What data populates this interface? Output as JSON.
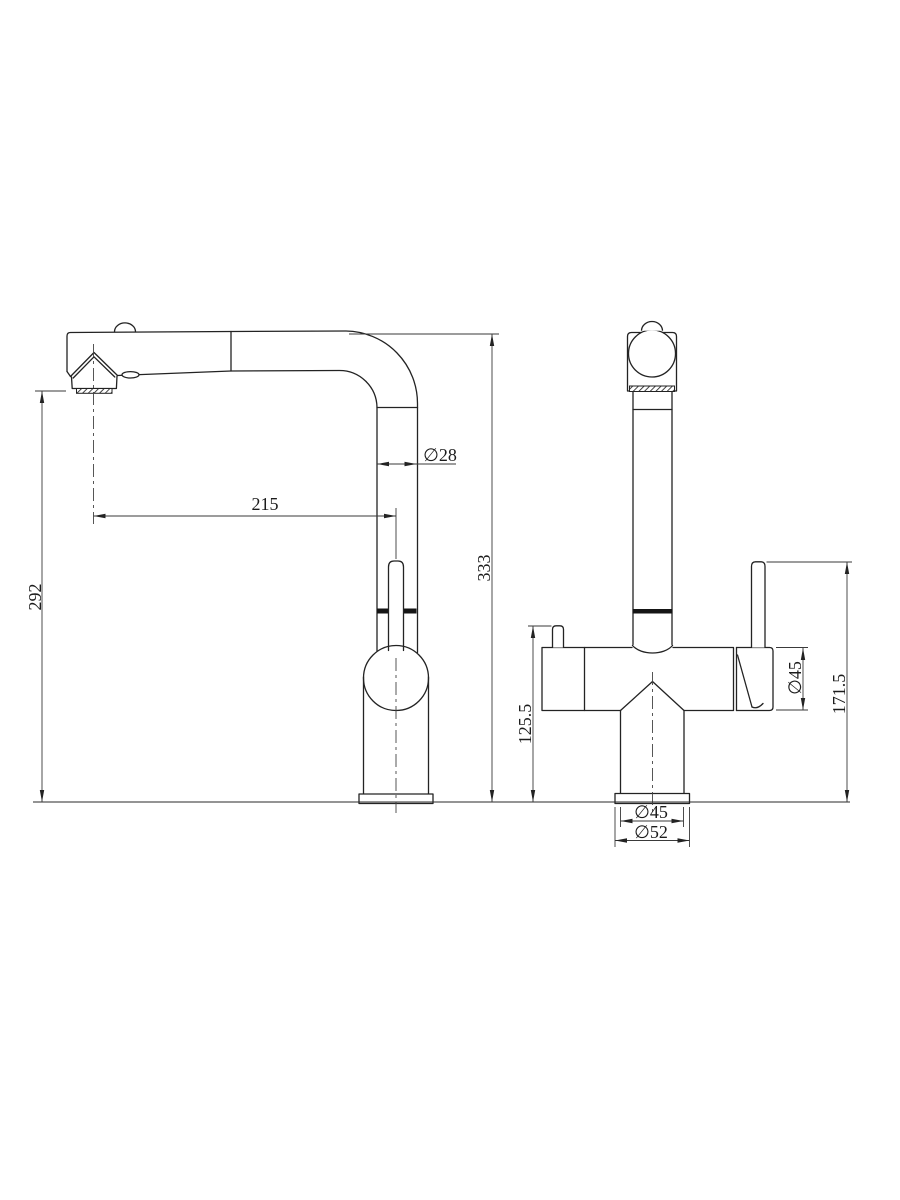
{
  "drawing": {
    "background": "#ffffff",
    "line_color": "#232323",
    "views": {
      "side": {
        "label": "side-view",
        "dims": {
          "spout_height": "292",
          "spout_reach": "215",
          "spout_tube_diameter": "∅28",
          "overall_height": "333"
        }
      },
      "front": {
        "label": "front-view",
        "dims": {
          "body_top_height": "125.5",
          "valve_body_diameter": "∅45",
          "handle_top_height": "171.5",
          "base_diameter": "∅45",
          "flange_diameter": "∅52"
        }
      }
    }
  }
}
